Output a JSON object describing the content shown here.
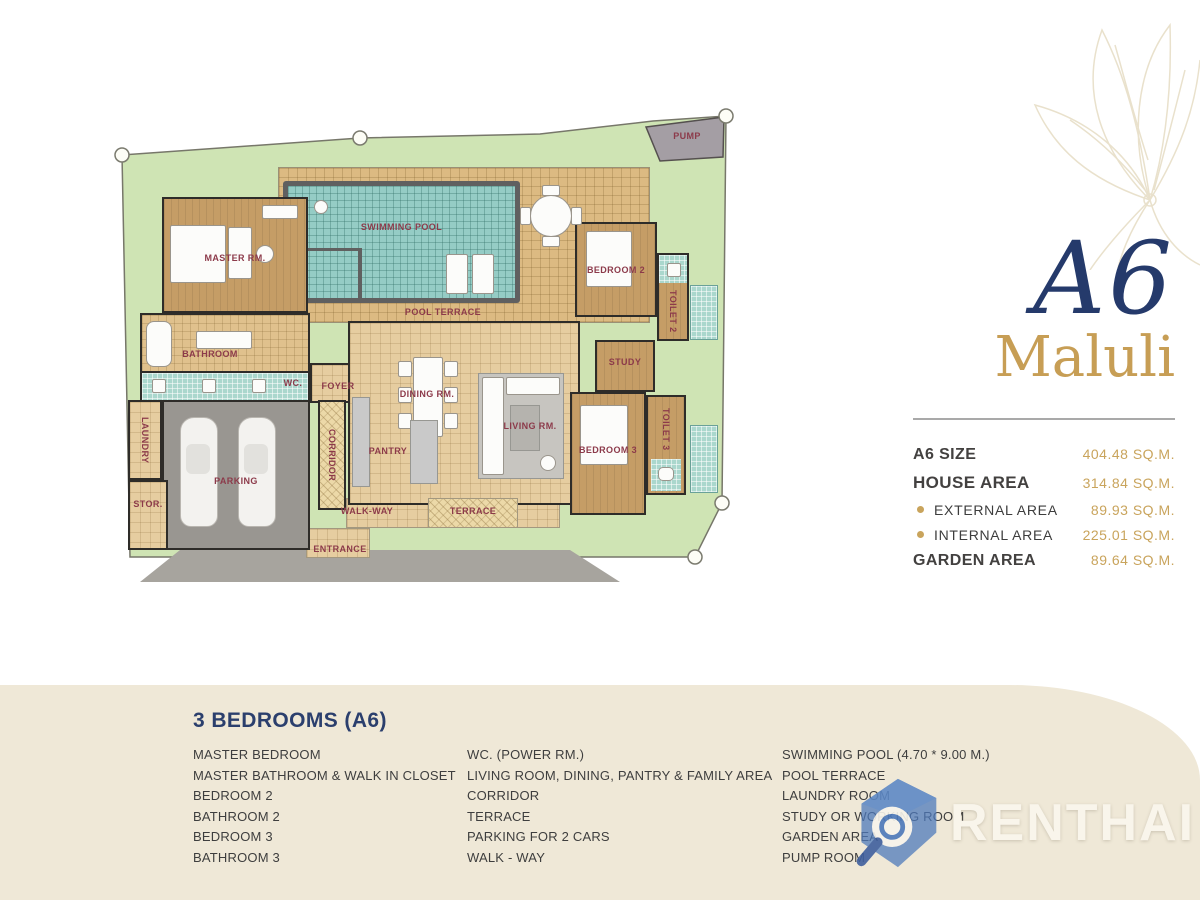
{
  "title": {
    "unit": "A6",
    "name": "Maluli"
  },
  "stats": {
    "rows": [
      {
        "label": "A6 SIZE",
        "value": "404.48 SQ.M."
      },
      {
        "label": "HOUSE AREA",
        "value": "314.84 SQ.M."
      },
      {
        "label": "EXTERNAL AREA",
        "value": "89.93 SQ.M."
      },
      {
        "label": "INTERNAL AREA",
        "value": "225.01 SQ.M."
      },
      {
        "label": "GARDEN AREA",
        "value": "89.64 SQ.M."
      }
    ]
  },
  "legend": {
    "heading": "3 BEDROOMS (A6)",
    "columns": [
      {
        "items": [
          "MASTER BEDROOM",
          "MASTER BATHROOM & WALK IN CLOSET",
          "BEDROOM 2",
          "BATHROOM 2",
          "BEDROOM 3",
          "BATHROOM 3"
        ]
      },
      {
        "items": [
          "WC. (POWER RM.)",
          "LIVING ROOM, DINING, PANTRY & FAMILY AREA",
          "CORRIDOR",
          "TERRACE",
          "PARKING FOR 2 CARS",
          "WALK - WAY"
        ]
      },
      {
        "items": [
          "SWIMMING POOL (4.70 * 9.00 M.)",
          "POOL TERRACE",
          "LAUNDRY ROOM",
          "STUDY OR WORKING ROOM",
          "GARDEN AREA",
          "PUMP ROOM"
        ]
      }
    ]
  },
  "plan": {
    "labels": {
      "pump": "PUMP",
      "swimming_pool": "SWIMMING POOL",
      "pool_terrace": "POOL TERRACE",
      "master_room": "MASTER RM.",
      "bathroom": "BATHROOM",
      "wc": "WC.",
      "foyer": "FOYER",
      "dining_room": "DINING RM.",
      "pantry": "PANTRY",
      "living_room": "LIVING RM.",
      "corridor": "CORRIDOR",
      "study": "STUDY",
      "bedroom2": "BEDROOM 2",
      "toilet2": "TOILET 2",
      "bedroom3": "BEDROOM 3",
      "toilet3": "TOILET 3",
      "laundry": "LAUNDRY",
      "storage": "STOR.",
      "parking": "PARKING",
      "walkway": "WALK-WAY",
      "terrace": "TERRACE",
      "entrance": "ENTRANCE"
    }
  },
  "watermark": {
    "text": "RENTHAI"
  },
  "colors": {
    "accent_navy": "#253a6b",
    "accent_gold": "#c79e55",
    "label_maroon": "#8c3a4a",
    "garden_green": "#cfe4b4",
    "pool_teal": "#95ccc5",
    "panel_beige": "#efe8d7"
  }
}
